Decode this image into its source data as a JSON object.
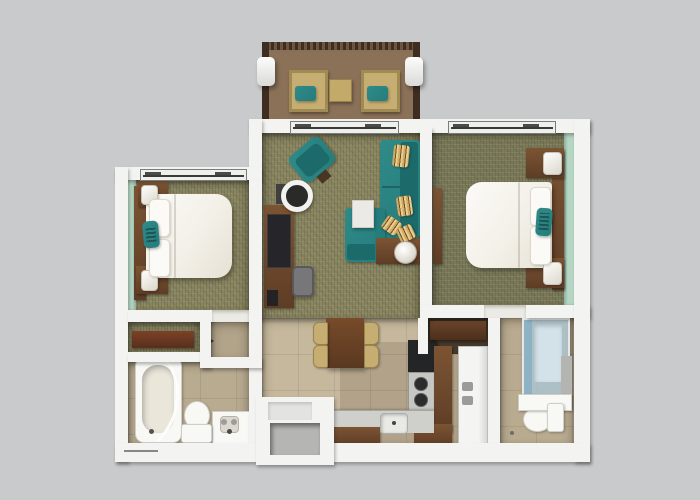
{
  "scene": {
    "kind": "3d-rendered-floor-plan-top-view",
    "description": "Two-bedroom suite floor plan rendered in 3D top-down view on a gray background, with balcony, living room, dining area, kitchen, two bedrooms and two bathrooms",
    "visible_text": []
  },
  "palette": {
    "bg": "#c8cacb",
    "wall": "#f3f3f1",
    "wall_inset": "#e3e3e1",
    "recess": "#b5b5b3",
    "carpet": "#8b8562",
    "carpet_dark": "#7c785a",
    "tile": "#c6b89c",
    "tile_bath": "#b9ab90",
    "tile_nook": "#b2a489",
    "deck": "#8b7157",
    "rail": "#3f2d21",
    "wood": "#5e3d26",
    "wood_light": "#7c5433",
    "wood_red": "#7d4028",
    "teal": "#257d7c",
    "teal_dark": "#1c6b6a",
    "teal_light": "#2f8a88",
    "accent_green": "#b4d6c3",
    "gold_chair": "#c6ae72",
    "glass": "#a9c4d2",
    "steel": "#cfcfcb",
    "stove_black": "#232527",
    "gray_chair": "#77777a",
    "fixture_white": "#f8f8f5"
  },
  "rooms": [
    {
      "name": "balcony",
      "furniture": [
        "patio-chair",
        "patio-chair",
        "patio-side-table",
        "railing",
        "pillar",
        "pillar"
      ]
    },
    {
      "name": "living-room",
      "furniture": [
        "sectional-sofa",
        "accent-armchair",
        "round-side-table",
        "tv-console",
        "tv",
        "desk-chair",
        "end-table",
        "table-lamp",
        "throw-pillows",
        "sliding-door"
      ]
    },
    {
      "name": "bedroom-left",
      "furniture": [
        "bed",
        "headboard",
        "nightstand",
        "nightstand",
        "lamp",
        "lamp",
        "teal-pillow",
        "window",
        "accent-wall"
      ]
    },
    {
      "name": "bedroom-right",
      "furniture": [
        "bed",
        "headboard",
        "nightstand",
        "nightstand",
        "lamp",
        "lamp",
        "teal-pillow",
        "dresser",
        "window",
        "accent-wall"
      ]
    },
    {
      "name": "closet",
      "furniture": [
        "shelf"
      ]
    },
    {
      "name": "bathroom-left",
      "furniture": [
        "bathtub",
        "shower-curtain",
        "toilet",
        "vanity-sink"
      ]
    },
    {
      "name": "dining-area",
      "furniture": [
        "dining-table",
        "dining-chair",
        "dining-chair",
        "dining-chair",
        "dining-chair"
      ]
    },
    {
      "name": "kitchen",
      "furniture": [
        "range-stove",
        "cooktop",
        "counter",
        "kitchen-sink",
        "refrigerator",
        "cabinet-niche"
      ]
    },
    {
      "name": "bathroom-right",
      "furniture": [
        "glass-shower",
        "vanity-ledge",
        "toilet",
        "wall-panel"
      ]
    },
    {
      "name": "entry",
      "furniture": [
        "entry-vestibule"
      ]
    }
  ]
}
